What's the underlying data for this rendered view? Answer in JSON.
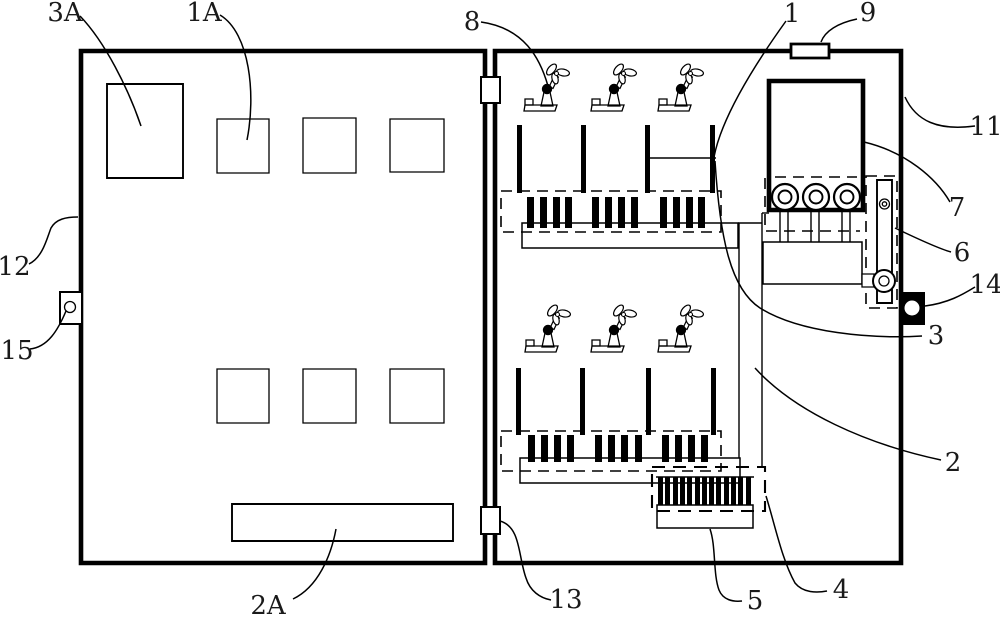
{
  "figure": {
    "background": "#ffffff",
    "ink": "#000000"
  },
  "callouts": {
    "c3A": "3A",
    "c1A": "1A",
    "c8": "8",
    "c1": "1",
    "c9": "9",
    "c11": "11",
    "c7": "7",
    "c6": "6",
    "c14": "14",
    "c3": "3",
    "c2": "2",
    "c12": "12",
    "c15": "15",
    "c2A": "2A",
    "c13": "13",
    "c5": "5",
    "c4": "4"
  }
}
